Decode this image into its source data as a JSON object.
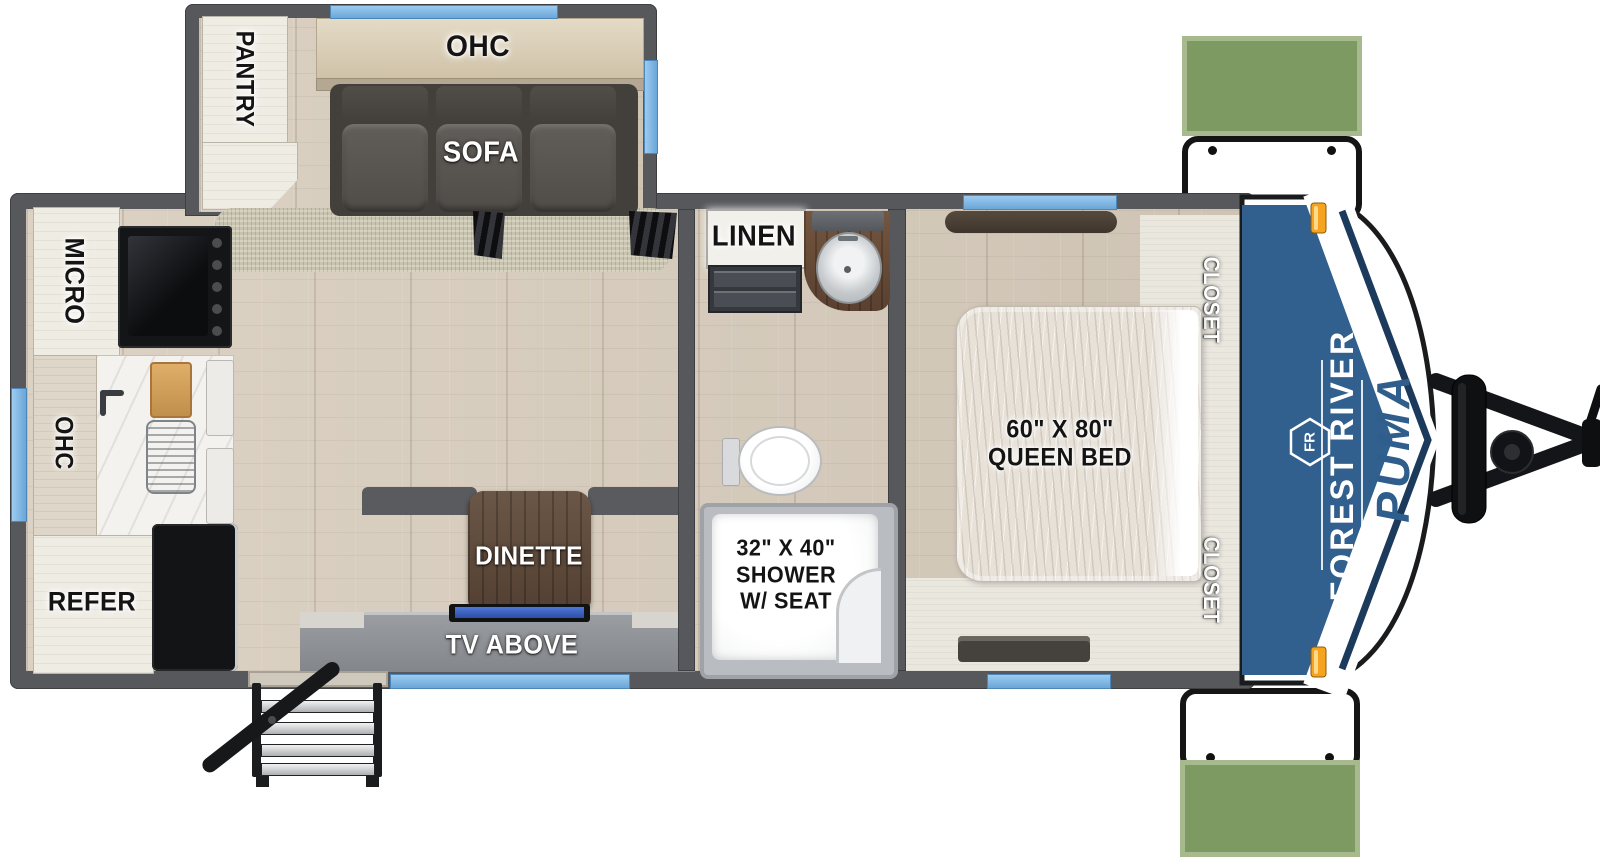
{
  "branding": {
    "manufacturer": "FOREST RIVER",
    "model": "PUMA",
    "logo_monogram": "FR"
  },
  "callouts": {
    "outside_storage_top": {
      "line1": "OUTSIDE",
      "line2": "STORAGE"
    },
    "outside_storage_bottom": {
      "line1": "OUTSIDE",
      "line2": "STORAGE"
    }
  },
  "living_area": {
    "pantry": "PANTRY",
    "overhead_cabinet": "OHC",
    "sofa": "SOFA",
    "dinette": "DINETTE",
    "tv": "TV ABOVE"
  },
  "kitchen": {
    "microwave": "MICRO",
    "overhead_cabinet": "OHC",
    "refrigerator": "REFER"
  },
  "bathroom": {
    "linen": "LINEN",
    "shower": {
      "size": "32\" X 40\"",
      "name": "SHOWER",
      "feature": "W/ SEAT"
    }
  },
  "bedroom": {
    "bed": {
      "size": "60\" X 80\"",
      "name": "QUEEN BED"
    },
    "closet_top": "CLOSET",
    "closet_bottom": "CLOSET"
  },
  "colors": {
    "badge_green": "#7C9A62",
    "badge_green_light": "#A6BA8E",
    "wall_gray": "#57585C",
    "window_blue": "#7FB5E4",
    "cap_blue": "#31608E",
    "marker_orange": "#F39C1D",
    "tv_blue": "#3B63C5",
    "floor_wood": "#D7CCBD"
  }
}
